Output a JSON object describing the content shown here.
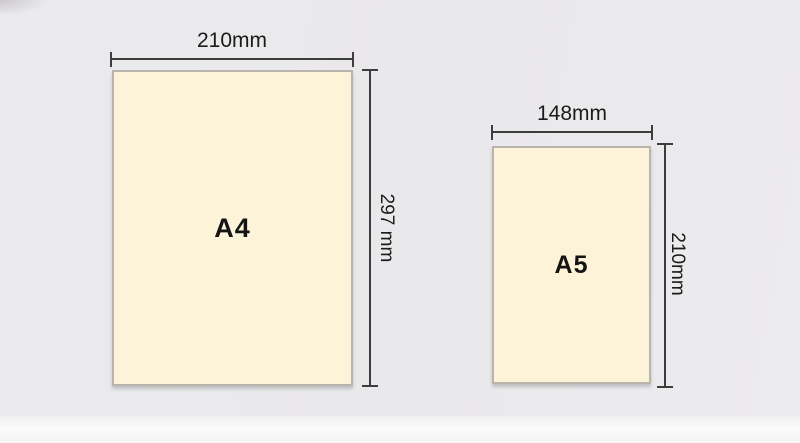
{
  "colors": {
    "background": "#eae9eb",
    "floor": "#f7f6f7",
    "paper_fill": "#fdf3d8",
    "paper_border": "#b9b5ad",
    "dimension_line": "#3d3d3d",
    "text": "#1b1b1b"
  },
  "papers": [
    {
      "name": "A4",
      "width_label": "210mm",
      "height_label": "297 mm",
      "width_mm": 210,
      "height_mm": 297
    },
    {
      "name": "A5",
      "width_label": "148mm",
      "height_label": "210mm",
      "width_mm": 148,
      "height_mm": 210
    }
  ]
}
